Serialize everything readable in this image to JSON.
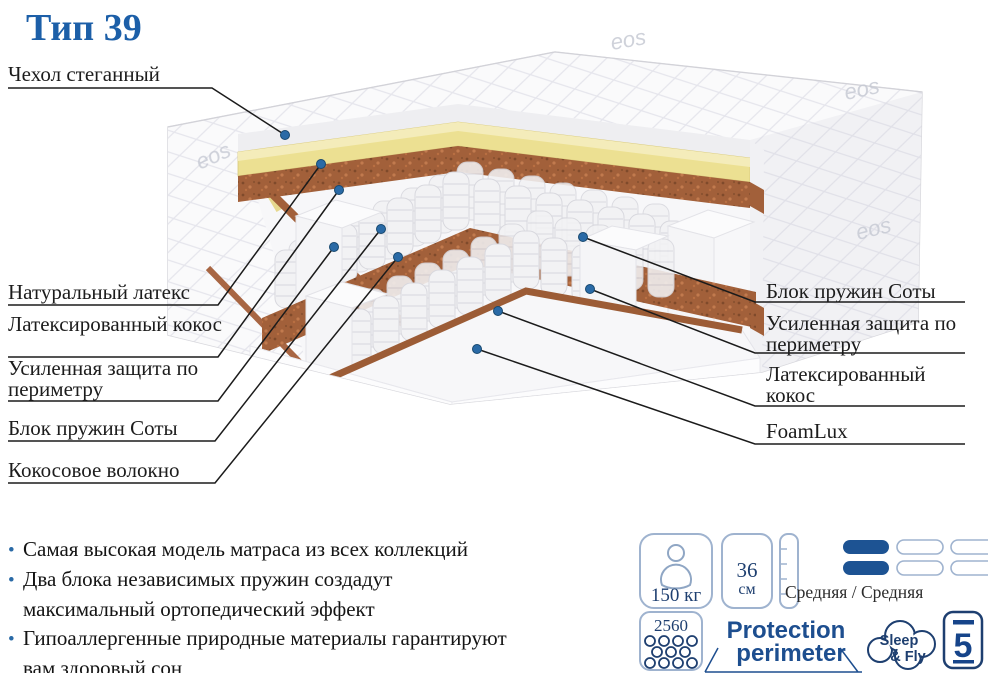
{
  "title": "Тип 39",
  "diagram": {
    "watermark": "eos",
    "labels_left": [
      "Чехол стеганный",
      "Натуральный латекс",
      "Латексированный кокос",
      "Усиленная защита по периметру",
      "Блок пружин Соты",
      "Кокосовое волокно"
    ],
    "labels_right": [
      "Блок пружин Соты",
      "Усиленная защита по периметру",
      "Латексированный кокос",
      "FoamLux"
    ]
  },
  "bullets": [
    {
      "marker": "•",
      "text": "Самая высокая модель матраса из всех коллекций"
    },
    {
      "marker": "•",
      "text": "Два блока независимых пружин создадут"
    },
    {
      "marker": "",
      "text": "максимальный ортопедический эффект"
    },
    {
      "marker": "•",
      "text": "Гипоаллергенные природные материалы гарантируют"
    },
    {
      "marker": "",
      "text": "вам здоровый сон"
    }
  ],
  "features": {
    "max_weight": "150 кг",
    "height_value": "36",
    "height_unit": "см",
    "firmness": "Средняя / Средняя",
    "springs_count": "2560",
    "protection_line1": "Protection",
    "protection_line2": "perimeter",
    "brand_line1": "Sleep",
    "brand_line2": "& Fly",
    "warranty": "5"
  },
  "colors": {
    "accent": "#1c5fa8",
    "navy": "#1e3f70",
    "latex": "#ece092",
    "coir": "#a2603a",
    "pill_filled": "#1d5393"
  }
}
